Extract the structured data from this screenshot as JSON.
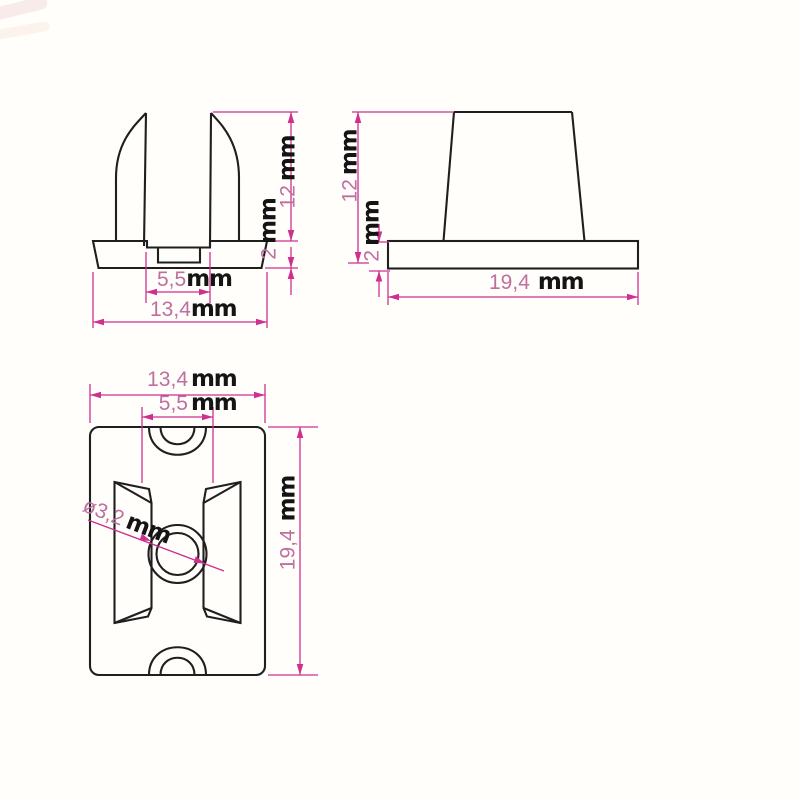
{
  "drawing": {
    "type": "technical-dimension-drawing",
    "background": "#fffefb",
    "views": [
      {
        "id": "front-view",
        "description": "front elevation with two curved prongs on stepped base"
      },
      {
        "id": "side-view",
        "description": "side elevation, tapered body on flat base"
      },
      {
        "id": "top-view",
        "description": "plan view with center hole, side slots and end notches"
      }
    ]
  },
  "colors": {
    "part_outline": "#1f1f1f",
    "dimension_lines": "#cf2f8f",
    "dimension_numbers": "#bf6f9f",
    "unit_text": "#141414"
  },
  "dimensions": {
    "front_view": {
      "slot_width": {
        "value": "5,5",
        "unit": "mm"
      },
      "overall_width": {
        "value": "13,4",
        "unit": "mm"
      },
      "body_height": {
        "value": "12",
        "unit": "mm"
      },
      "base_thickness": {
        "value": "2",
        "unit": "mm"
      }
    },
    "side_view": {
      "body_height": {
        "value": "12",
        "unit": "mm"
      },
      "base_thickness": {
        "value": "2",
        "unit": "mm"
      },
      "base_width": {
        "value": "19,4",
        "unit": "mm"
      }
    },
    "top_view": {
      "overall_width": {
        "value": "13,4",
        "unit": "mm"
      },
      "slot_width": {
        "value": "5,5",
        "unit": "mm"
      },
      "overall_length": {
        "value": "19,4",
        "unit": "mm"
      },
      "hole_diameter": {
        "value": "ø3,2",
        "unit": "mm"
      }
    }
  }
}
